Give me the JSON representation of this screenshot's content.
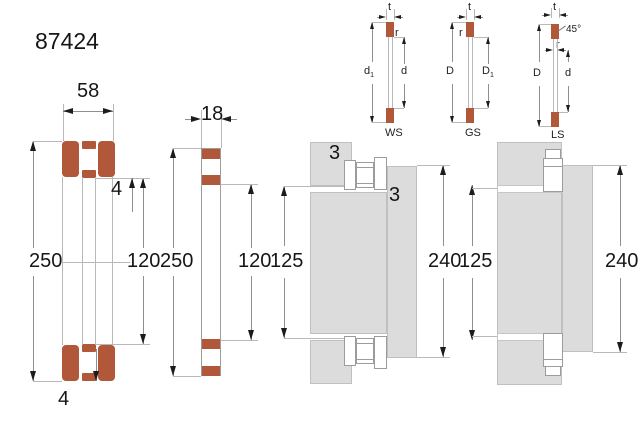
{
  "title": "87424",
  "bearing": {
    "width": "58",
    "od": "250",
    "bore": "120",
    "lip_top": "4",
    "lip_bottom": "4"
  },
  "washer": {
    "width": "18",
    "od": "250",
    "bore": "120"
  },
  "mount1": {
    "fillet1": "3",
    "fillet2": "3",
    "shaft": "125",
    "housing": "240"
  },
  "mount2": {
    "shaft": "125",
    "housing": "240"
  },
  "ws": {
    "t": "t",
    "r": "r",
    "d1b": "d",
    "d1s": "1",
    "d": "d",
    "name": "WS"
  },
  "gs": {
    "t": "t",
    "r": "r",
    "D": "D",
    "D1b": "D",
    "D1s": "1",
    "name": "GS"
  },
  "ls": {
    "t": "t",
    "r": "r",
    "angle": "45°",
    "D": "D",
    "d": "d",
    "name": "LS"
  }
}
